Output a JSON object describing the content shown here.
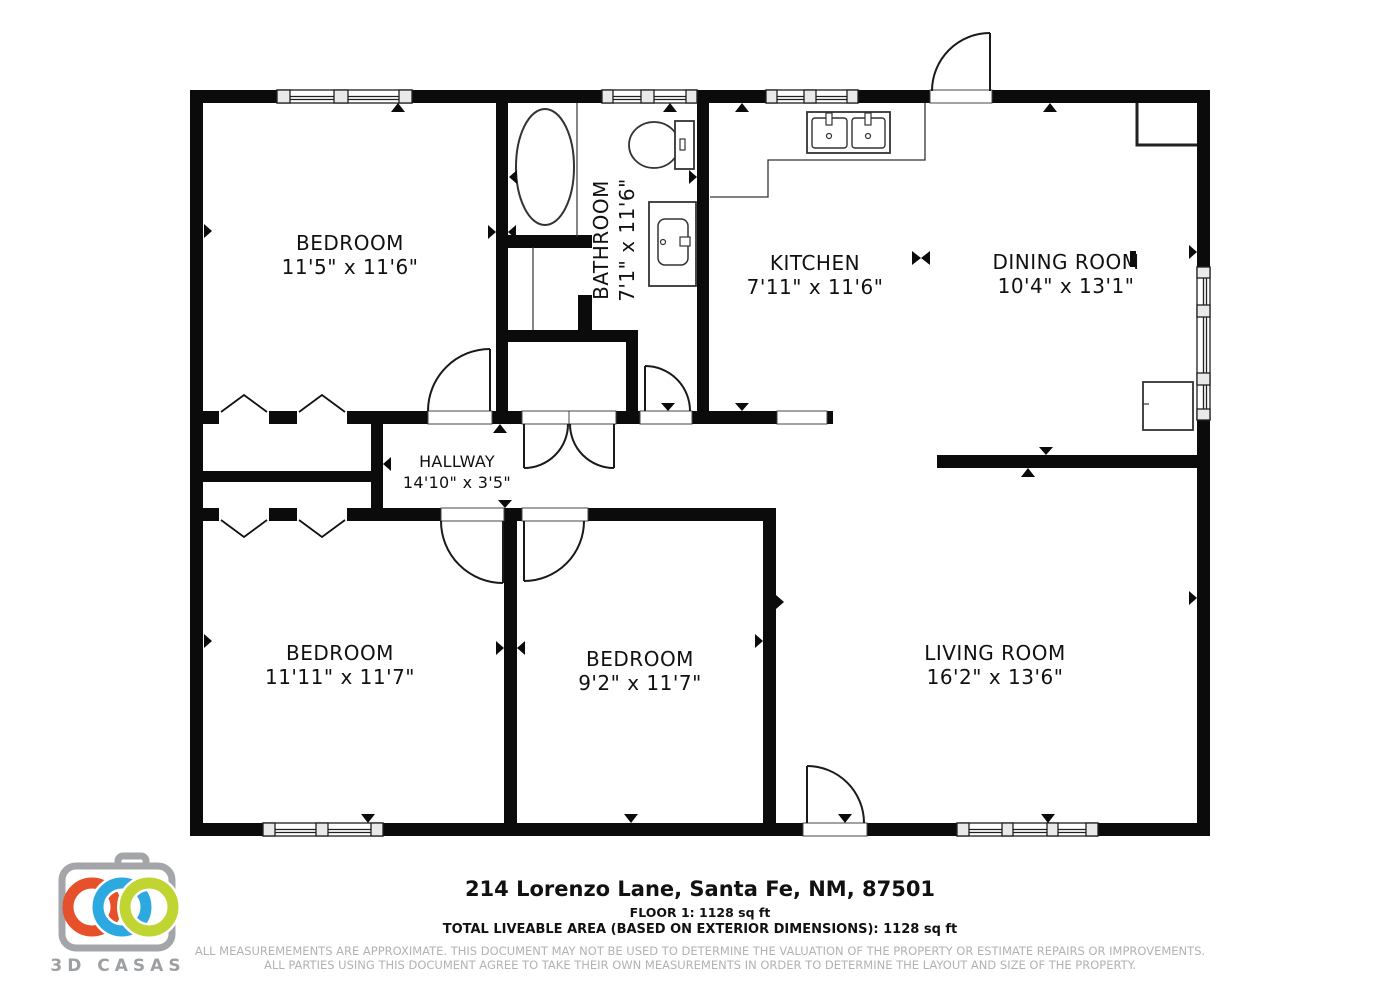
{
  "floorplan": {
    "rooms": {
      "bedroom1": {
        "name": "BEDROOM",
        "dims": "11'5\" x 11'6\""
      },
      "bathroom": {
        "name": "BATHROOM",
        "dims": "7'1\" x 11'6\""
      },
      "kitchen": {
        "name": "KITCHEN",
        "dims": "7'11\" x 11'6\""
      },
      "dining": {
        "name": "DINING ROOM",
        "dims": "10'4\" x 13'1\""
      },
      "hallway": {
        "name": "HALLWAY",
        "dims": "14'10\" x 3'5\""
      },
      "bedroom2": {
        "name": "BEDROOM",
        "dims": "11'11\" x 11'7\""
      },
      "bedroom3": {
        "name": "BEDROOM",
        "dims": "9'2\" x 11'7\""
      },
      "living": {
        "name": "LIVING ROOM",
        "dims": "16'2\" x 13'6\""
      }
    },
    "wall_color": "#0b0b0b"
  },
  "footer": {
    "address": "214 Lorenzo Lane, Santa Fe, NM, 87501",
    "floor_line": "FLOOR 1: 1128 sq ft",
    "total_line": "TOTAL LIVEABLE AREA (BASED ON EXTERIOR DIMENSIONS): 1128 sq ft",
    "disclaimer_line1": "ALL MEASUREMEMENTS ARE APPROXIMATE. THIS DOCUMENT MAY NOT BE USED TO DETERMINE THE VALUATION OF THE PROPERTY OR ESTIMATE REPAIRS OR IMPROVEMENTS.",
    "disclaimer_line2": "ALL PARTIES USING THIS DOCUMENT AGREE TO TAKE THEIR OWN MEASUREMENTS IN ORDER TO DETERMINE THE LAYOUT AND SIZE OF THE PROPERTY."
  },
  "logo": {
    "brand": "3D CASAS",
    "colors": {
      "orange": "#e6502a",
      "blue": "#2ba9e0",
      "green": "#c0d432",
      "gray": "#9da0a3"
    }
  }
}
